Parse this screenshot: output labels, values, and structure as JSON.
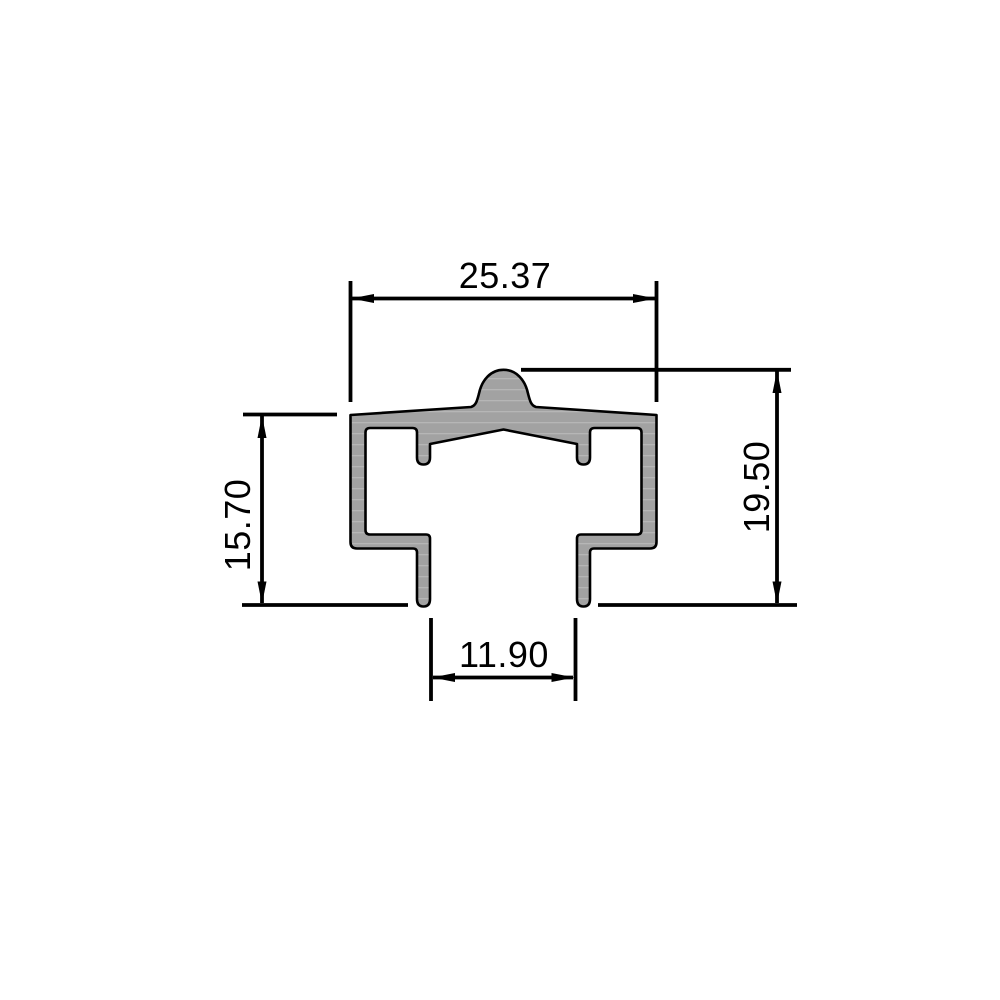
{
  "drawing": {
    "colors": {
      "background": "#ffffff",
      "profile_fill": "#a2a2a2",
      "profile_streak": "#ffffff",
      "line": "#000000"
    },
    "dimensions": {
      "top_width": "25.37",
      "left_height": "15.70",
      "right_height": "19.50",
      "bottom_gap": "11.90"
    }
  }
}
